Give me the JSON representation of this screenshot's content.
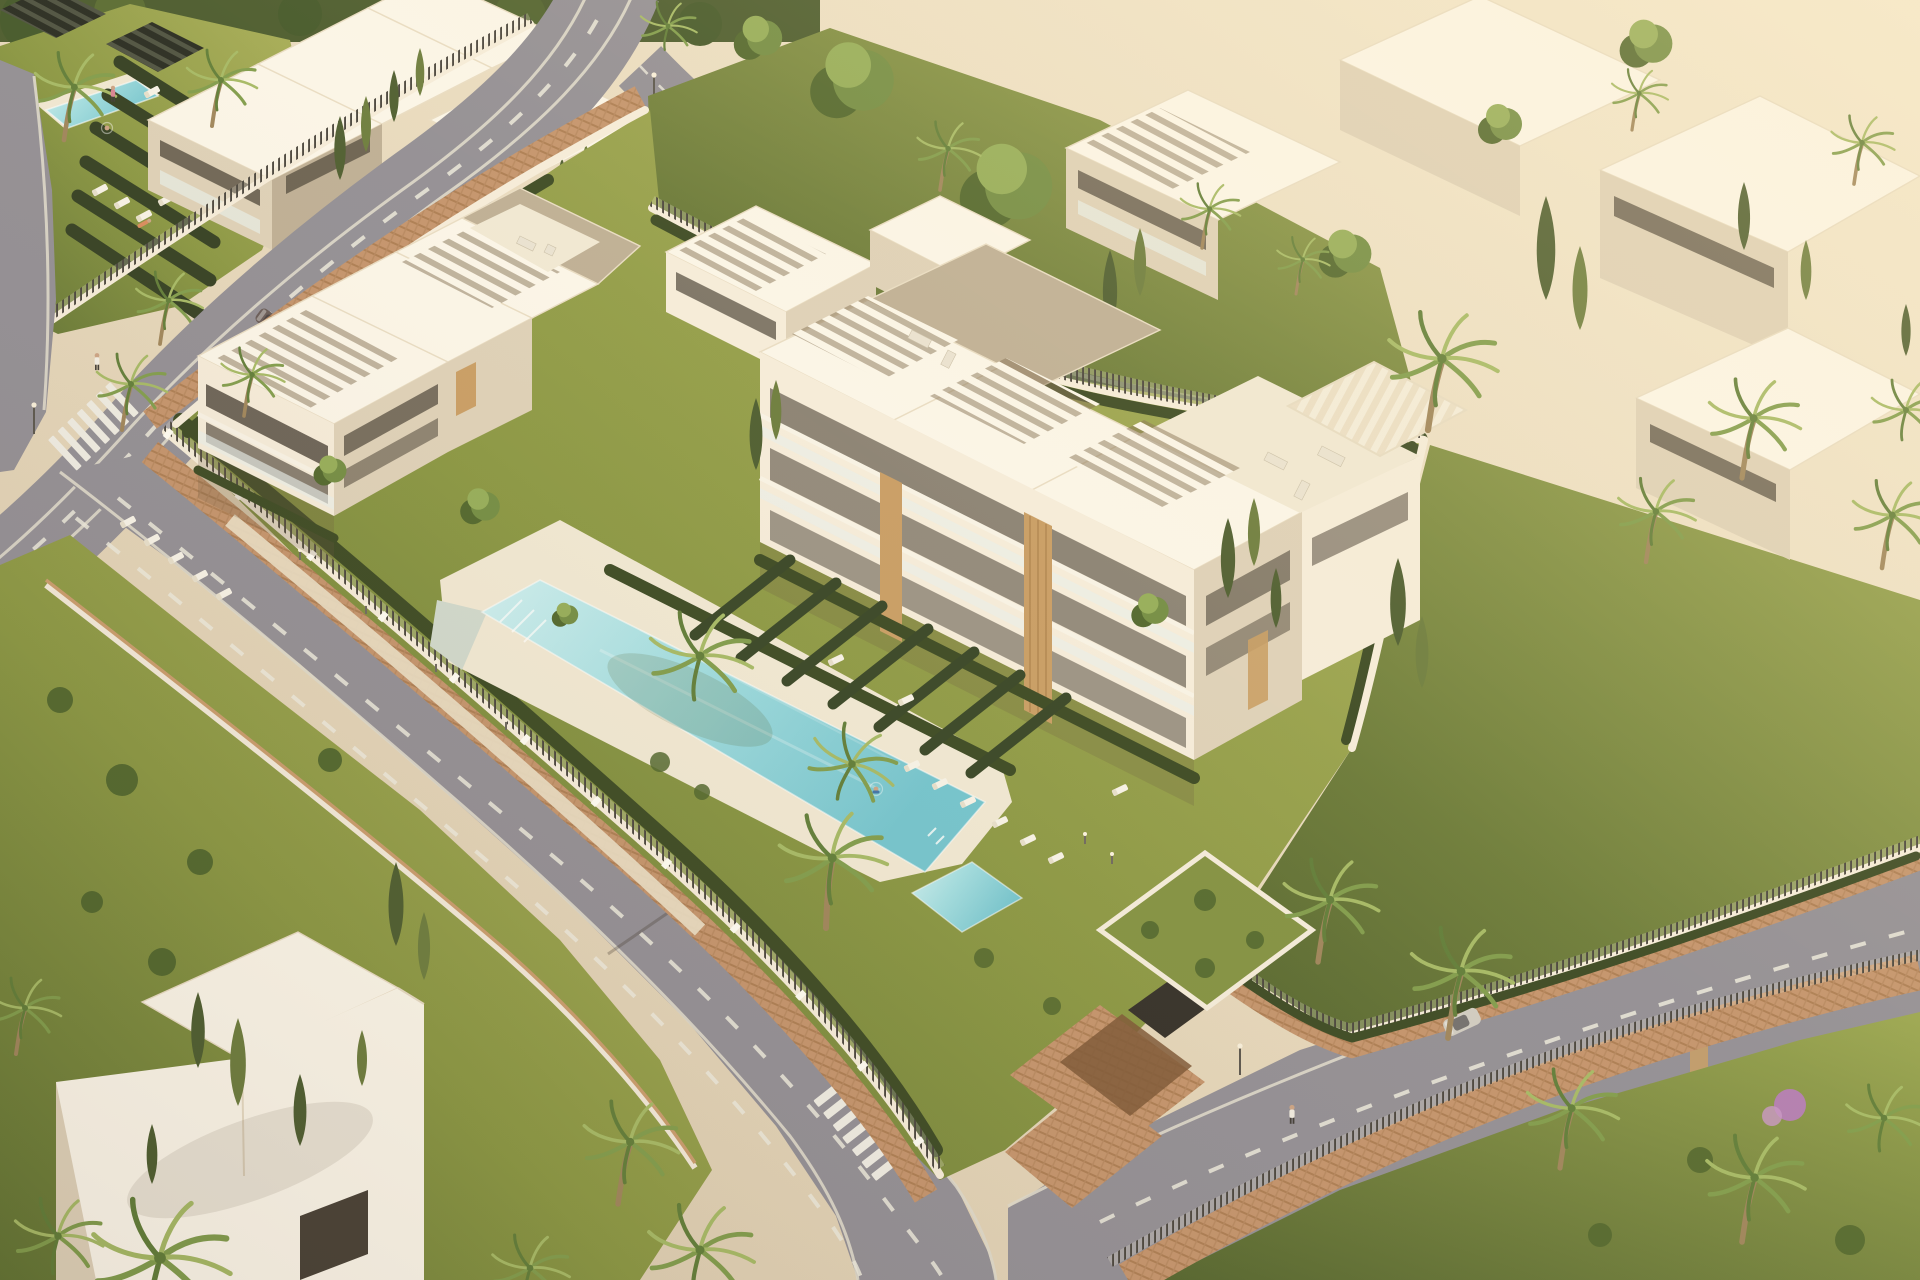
{
  "meta": {
    "title": "Aerial golden-hour rendering of a modern white Mediterranean apartment complex with pools, palm gardens and surrounding streets",
    "image_type": "3d-architectural-visualization",
    "view": "high-angle aerial, oblique",
    "lighting": "warm low sun from upper right, long soft shadows to lower left"
  },
  "palette": {
    "ground": "#e5d7bc",
    "ground-lit": "#f2e7cf",
    "road": "#8f8c94",
    "road-shade": "#7d7982",
    "dash": "#ebe9dd",
    "curb": "#ddd8cb",
    "brick": "#c2916a",
    "brick-dark": "#a97a51",
    "brick-lit": "#d6ae88",
    "lawn": "#9aa34f",
    "lawn-dark": "#73823a",
    "lawn-deep": "#55662c",
    "hedge": "#36451f",
    "cypress": "#48592c",
    "cypress-lit": "#68793a",
    "palm": "#7d9a49",
    "palm-light": "#a3b863",
    "palm-dark": "#5c7a35",
    "trunk": "#9c8258",
    "tree": "#6f8a40",
    "tree-light": "#92ab56",
    "tree-dark": "#4c6329",
    "pool": "#9fdde2",
    "pool-deep": "#6fc3cf",
    "pool-light": "#cdeff1",
    "deck": "#f0e8d4",
    "white-roof": "#fbf6ea",
    "white-wall": "#f5ecdb",
    "wall-shade": "#ddd0b8",
    "wall-deep": "#bcad94",
    "opening": "#433c32",
    "glass": "#5d5f5c",
    "balustrade": "#e8efec",
    "wood": "#c79b62",
    "slat-shadow": "#8c7a5e",
    "dark-pergola": "#23261d",
    "dark-pergola-slat": "#494e3e",
    "fence": "#44403a",
    "car-silver": "#d8d4cb",
    "car-dark": "#635654",
    "skin": "#caa183",
    "swimsuit": "#3a6fa8",
    "pink-swimsuit": "#d77f93",
    "flower-shrub": "#b07ab0",
    "shadow": "#64503a"
  },
  "scene": {
    "main_complex": {
      "buildings": [
        "west apartment block with rooftop slat pergolas",
        "north wing",
        "east apartment block with 4 balcony floors, wood-slat columns and cream awning terrace"
      ],
      "amenities": {
        "main_pool": "long turquoise lap pool with infinity edge and ladder",
        "plunge_pool": "small square pool",
        "pool_deck": "cream stone deck",
        "sun_loungers_approx": 30,
        "underground_garage": "brick ramp under planted green roof",
        "gardens": "lawns, clipped hedge rows separating ground-floor terraces, garden light bollards"
      },
      "perimeter": "white wall with dark vertical-bar fence panels, inner hedge, outer terracotta brick walkway"
    },
    "neighbour_complexes": {
      "north_west": "sister complex with own pool, dark pergolas, lounger terraces",
      "north_east": "white blocks behind two large canopy trees and cypresses",
      "east": "white block seen through palm tops",
      "south_west": "flat-roofed white villa in a cypress garden, palm over roof"
    },
    "roads": [
      "curved street from top centre to left edge",
      "narrow branch street behind the complex to the north-east",
      "street along the south-west wall running to bottom centre",
      "avenue along the south-east with brick pedestrian promenade and palm alley"
    ],
    "crosswalks": 3,
    "vehicles": [
      {
        "name": "dark car",
        "location": "upper left street"
      },
      {
        "name": "silver car",
        "location": "upper left street, near crosswalk"
      },
      {
        "name": "silver car",
        "location": "south-east avenue under palms"
      }
    ],
    "people": [
      "pedestrian on upper-left sidewalk",
      "pedestrian at branch-road crosswalk",
      "walker on lower-left street",
      "walker on south-east promenade",
      "swimmer in main pool",
      "two bathers at neighbour pool",
      "sunbather on neighbour lawn"
    ],
    "vegetation": {
      "palm_trees_approx": 26,
      "cypresses_approx": 28,
      "canopy_trees_approx": 9,
      "flowering_shrub": "purple bougainvillea near promenade"
    },
    "street_furniture": {
      "lamp_posts": 5,
      "garden_bollards": 6
    }
  }
}
